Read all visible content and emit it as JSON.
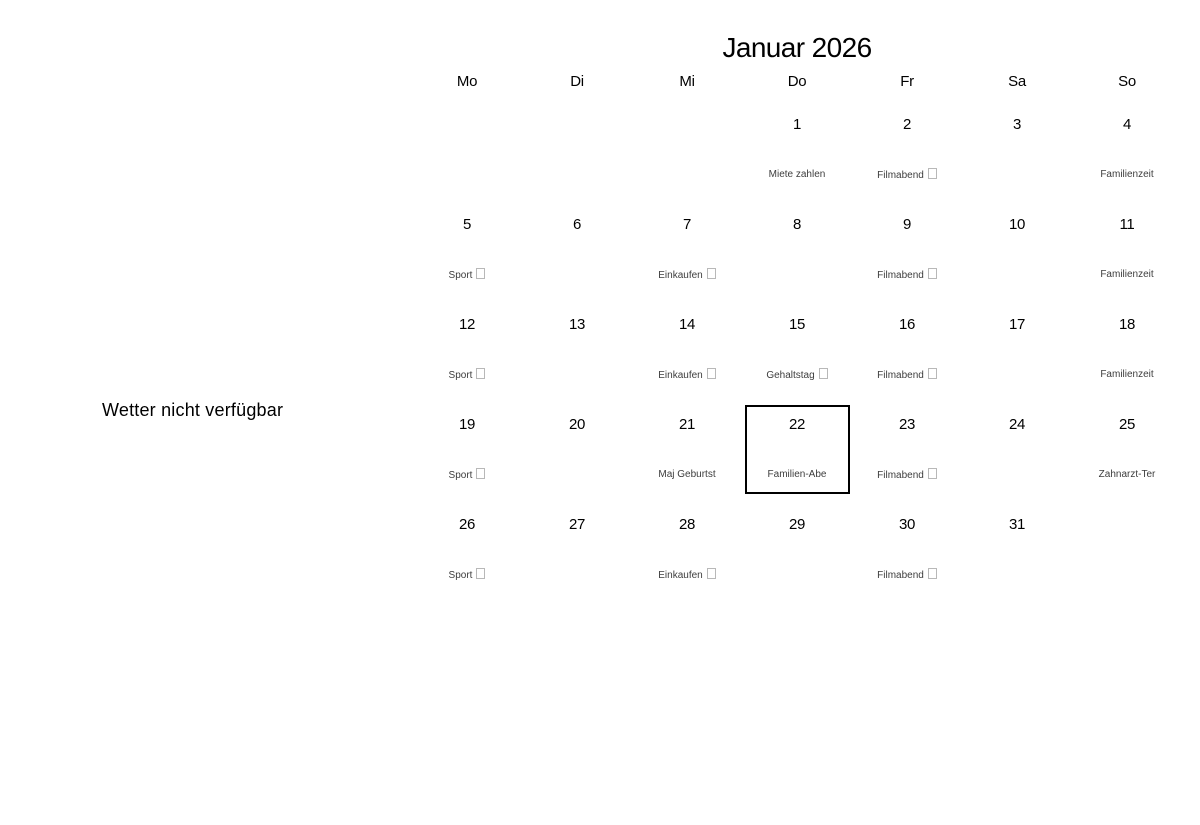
{
  "weather_notice": {
    "text": "Wetter nicht verfügbar"
  },
  "calendar": {
    "title": "Januar 2026",
    "weekday_headers": [
      "Mo",
      "Di",
      "Mi",
      "Do",
      "Fr",
      "Sa",
      "So"
    ],
    "selected_day": "22",
    "weeks": [
      [
        {
          "day": "",
          "event": "",
          "missing_glyph": false,
          "selected": false
        },
        {
          "day": "",
          "event": "",
          "missing_glyph": false,
          "selected": false
        },
        {
          "day": "",
          "event": "",
          "missing_glyph": false,
          "selected": false
        },
        {
          "day": "1",
          "event": "Miete zahlen",
          "missing_glyph": false,
          "selected": false
        },
        {
          "day": "2",
          "event": "Filmabend",
          "missing_glyph": true,
          "selected": false
        },
        {
          "day": "3",
          "event": "",
          "missing_glyph": false,
          "selected": false
        },
        {
          "day": "4",
          "event": "Familienzeit",
          "missing_glyph": false,
          "selected": false
        }
      ],
      [
        {
          "day": "5",
          "event": "Sport",
          "missing_glyph": true,
          "selected": false
        },
        {
          "day": "6",
          "event": "",
          "missing_glyph": false,
          "selected": false
        },
        {
          "day": "7",
          "event": "Einkaufen",
          "missing_glyph": true,
          "selected": false
        },
        {
          "day": "8",
          "event": "",
          "missing_glyph": false,
          "selected": false
        },
        {
          "day": "9",
          "event": "Filmabend",
          "missing_glyph": true,
          "selected": false
        },
        {
          "day": "10",
          "event": "",
          "missing_glyph": false,
          "selected": false
        },
        {
          "day": "11",
          "event": "Familienzeit",
          "missing_glyph": false,
          "selected": false
        }
      ],
      [
        {
          "day": "12",
          "event": "Sport",
          "missing_glyph": true,
          "selected": false
        },
        {
          "day": "13",
          "event": "",
          "missing_glyph": false,
          "selected": false
        },
        {
          "day": "14",
          "event": "Einkaufen",
          "missing_glyph": true,
          "selected": false
        },
        {
          "day": "15",
          "event": "Gehaltstag",
          "missing_glyph": true,
          "selected": false
        },
        {
          "day": "16",
          "event": "Filmabend",
          "missing_glyph": true,
          "selected": false
        },
        {
          "day": "17",
          "event": "",
          "missing_glyph": false,
          "selected": false
        },
        {
          "day": "18",
          "event": "Familienzeit",
          "missing_glyph": false,
          "selected": false
        }
      ],
      [
        {
          "day": "19",
          "event": "Sport",
          "missing_glyph": true,
          "selected": false
        },
        {
          "day": "20",
          "event": "",
          "missing_glyph": false,
          "selected": false
        },
        {
          "day": "21",
          "event": "Maj Geburtst",
          "missing_glyph": false,
          "selected": false
        },
        {
          "day": "22",
          "event": "Familien-Abe",
          "missing_glyph": false,
          "selected": true
        },
        {
          "day": "23",
          "event": "Filmabend",
          "missing_glyph": true,
          "selected": false
        },
        {
          "day": "24",
          "event": "",
          "missing_glyph": false,
          "selected": false
        },
        {
          "day": "25",
          "event": "Zahnarzt-Ter",
          "missing_glyph": false,
          "selected": false
        }
      ],
      [
        {
          "day": "26",
          "event": "Sport",
          "missing_glyph": true,
          "selected": false
        },
        {
          "day": "27",
          "event": "",
          "missing_glyph": false,
          "selected": false
        },
        {
          "day": "28",
          "event": "Einkaufen",
          "missing_glyph": true,
          "selected": false
        },
        {
          "day": "29",
          "event": "",
          "missing_glyph": false,
          "selected": false
        },
        {
          "day": "30",
          "event": "Filmabend",
          "missing_glyph": true,
          "selected": false
        },
        {
          "day": "31",
          "event": "",
          "missing_glyph": false,
          "selected": false
        },
        {
          "day": "",
          "event": "",
          "missing_glyph": false,
          "selected": false
        }
      ]
    ],
    "colors": {
      "background": "#ffffff",
      "text": "#000000",
      "event_text": "#3d3d3d",
      "selected_day_border": "#000000",
      "missing_glyph_border": "#b8b8b8"
    }
  }
}
